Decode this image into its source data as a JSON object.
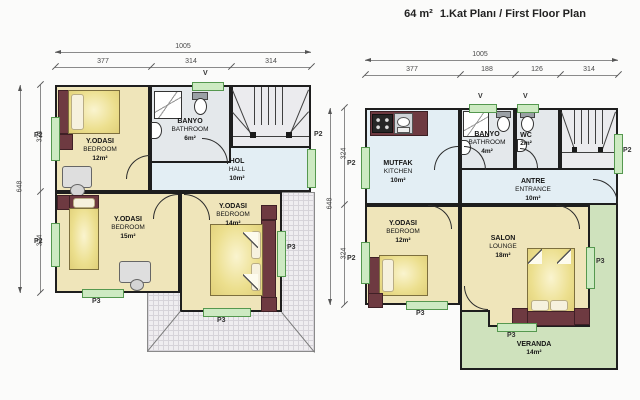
{
  "labels": {
    "p2": "P2",
    "p3": "P3",
    "v": "V"
  },
  "title": {
    "area": "64 m²",
    "text": "1.Kat Planı / First Floor Plan"
  },
  "left_plan": {
    "dims": {
      "total_w": "1005",
      "w1": "377",
      "w2": "314",
      "w3": "314",
      "total_h": "648",
      "h1": "324",
      "h2": "324"
    },
    "rooms": {
      "bedroom_top": {
        "tr": "Y.ODASI",
        "en": "BEDROOM",
        "area": "12m²"
      },
      "bathroom": {
        "tr": "BANYO",
        "en": "BATHROOM",
        "area": "6m²"
      },
      "hall": {
        "tr": "HOL",
        "en": "HALL",
        "area": "10m²"
      },
      "bedroom_left": {
        "tr": "Y.ODASI",
        "en": "BEDROOM",
        "area": "15m²"
      },
      "bedroom_mid": {
        "tr": "Y.ODASI",
        "en": "BEDROOM",
        "area": "14m²"
      }
    }
  },
  "right_plan": {
    "dims": {
      "total_w": "1005",
      "w1": "377",
      "w2": "188",
      "w3": "126",
      "w4": "314",
      "total_h": "648",
      "h1": "324",
      "h2": "324"
    },
    "rooms": {
      "kitchen": {
        "tr": "MUTFAK",
        "en": "KITCHEN",
        "area": "10m²"
      },
      "bathroom": {
        "tr": "BANYO",
        "en": "BATHROOM",
        "area": "4m²"
      },
      "wc": {
        "tr": "WC",
        "area": "2m²"
      },
      "entrance": {
        "tr": "ANTRE",
        "en": "ENTRANCE",
        "area": "10m²"
      },
      "bedroom": {
        "tr": "Y.ODASI",
        "en": "BEDROOM",
        "area": "12m²"
      },
      "lounge": {
        "tr": "SALON",
        "en": "LOUNGE",
        "area": "18m²"
      },
      "veranda": {
        "tr": "VERANDA",
        "area": "14m²"
      }
    }
  },
  "colors": {
    "wall": "#1e1e1e",
    "floor_room": "#efe5ba",
    "floor_wet": "#e4e8eb",
    "floor_hall": "#e3eef4",
    "floor_stairs": "#ebebee",
    "veranda": "#cfe2bd",
    "window": "#cdeac2",
    "roof_hatch": "#efedf0",
    "furniture_dark": "#6e3a41",
    "bed": "#ecdf8e"
  }
}
